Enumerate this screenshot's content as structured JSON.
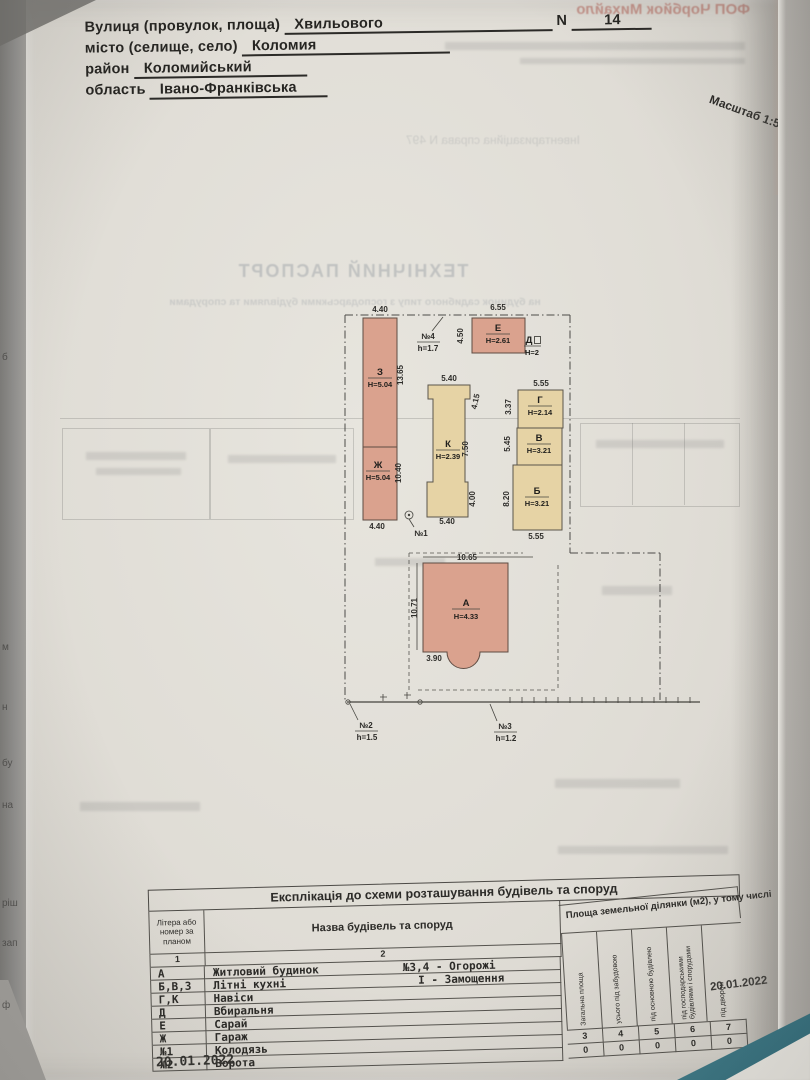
{
  "document": {
    "header": {
      "street_label": "Вулиця (провулок, площа)",
      "street_value": "Хвильового",
      "number_label": "N",
      "number_value": "14",
      "city_label": "місто (селище, село)",
      "city_value": "Коломия",
      "district_label": "район",
      "district_value": "Коломийський",
      "region_label": "область",
      "region_value": "Івано-Франківська"
    },
    "scale_note": "Масштаб 1:500",
    "bleedthrough": {
      "inventory_line": "Інвентаризаційна справа N 497",
      "passport_title": "ТЕХНІЧНИЙ ПАСПОРТ",
      "passport_subtitle": "на будинок садибного типу з господарськими будівлями та спорудами",
      "stamp_top": "ФОП Чорбйок Михайло"
    },
    "dates": {
      "bottom_left": "20.01.2022",
      "right_margin": "20.01.2022"
    },
    "edge_fragments": [
      "б",
      "м",
      "н",
      "бу",
      "на",
      "ріш",
      "зап",
      "ф"
    ]
  },
  "plan": {
    "buildings": [
      {
        "letter": "З",
        "height": "Н=5.04"
      },
      {
        "letter": "Ж",
        "height": "Н=5.04"
      },
      {
        "letter": "Е",
        "height": "Н=2.61"
      },
      {
        "letter": "Д",
        "height": "Н=2"
      },
      {
        "letter": "Г",
        "height": "Н=2.14"
      },
      {
        "letter": "В",
        "height": "Н=3.21"
      },
      {
        "letter": "Б",
        "height": "Н=3.21"
      },
      {
        "letter": "К",
        "height": "Н=2.39"
      },
      {
        "letter": "А",
        "height": "Н=4.33"
      }
    ],
    "markers": [
      {
        "label": "№4",
        "value": "h=1.7"
      },
      {
        "label": "№1",
        "value": ""
      },
      {
        "label": "№2",
        "value": "h=1.5"
      },
      {
        "label": "№3",
        "value": "h=1.2"
      }
    ],
    "dimensions": [
      "4.40",
      "6.55",
      "4.50",
      "13.65",
      "5.40",
      "4.15",
      "5.55",
      "3.37",
      "7.50",
      "5.45",
      "8.20",
      "10.40",
      "4.40",
      "5.40",
      "4.00",
      "5.55",
      "10.65",
      "10.71",
      "3.90"
    ]
  },
  "table": {
    "title": "Експлікація до схеми розташування будівель та споруд",
    "col1_header": "Літера або номер за планом",
    "col2_header": "Назва будівель та споруд",
    "area_group": "Площа земельної ділянки (м2), у тому числі",
    "subcols": [
      "Загальна площа",
      "усього під забудовою",
      "під основною будівлею",
      "під господарськими будівлями і спорудами",
      "під двором"
    ],
    "left_nums": [
      "1",
      "2"
    ],
    "right_nums": [
      "3",
      "4",
      "5",
      "6",
      "7"
    ],
    "zeros": [
      "0",
      "0",
      "0",
      "0",
      "0"
    ],
    "rows": [
      {
        "letter": "А",
        "name": "Житловий будинок",
        "note": "№3,4 - Огорожі"
      },
      {
        "letter": "Б,В,З",
        "name": "Літні кухні",
        "note": "І - Замощення"
      },
      {
        "letter": "Г,К",
        "name": "Навіси",
        "note": ""
      },
      {
        "letter": "Д",
        "name": "Вбиральня",
        "note": ""
      },
      {
        "letter": "Е",
        "name": "Сарай",
        "note": ""
      },
      {
        "letter": "Ж",
        "name": "Гараж",
        "note": ""
      },
      {
        "letter": "№1",
        "name": "Колодязь",
        "note": ""
      },
      {
        "letter": "№2",
        "name": "Ворота",
        "note": ""
      }
    ]
  }
}
